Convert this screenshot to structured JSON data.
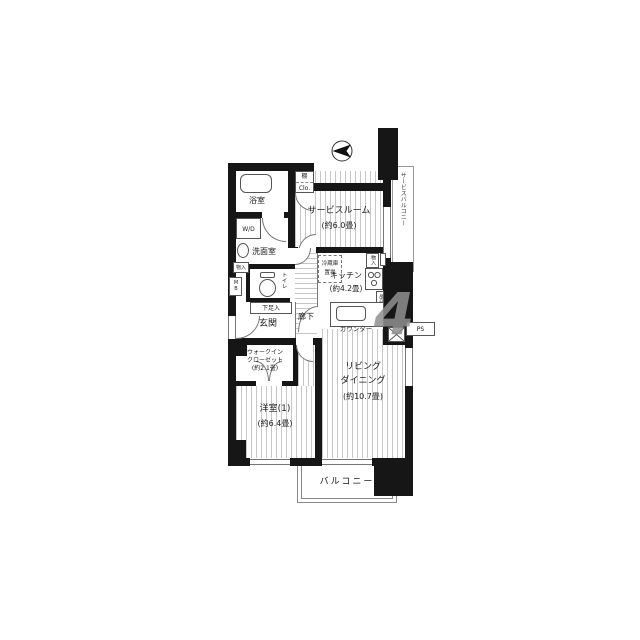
{
  "plan": {
    "watermark": "4",
    "rooms": {
      "service_room": {
        "name": "サービスルーム",
        "size": "(約6.0畳)"
      },
      "service_balcony": {
        "name": "サービスバルコニー"
      },
      "kitchen": {
        "name": "キッチン",
        "size": "(約4.2畳)"
      },
      "living_dining": {
        "line1": "リビング",
        "line2": "ダイニング",
        "size": "(約10.7畳)"
      },
      "western_room": {
        "name": "洋室(1)",
        "size": "(約6.4畳)"
      },
      "walk_in_closet": {
        "line1": "ウォークイン",
        "line2": "クローゼット",
        "size": "(約2.1畳)"
      },
      "bathroom": {
        "name": "浴室"
      },
      "washroom": {
        "name": "洗面室"
      },
      "toilet": {
        "name": "トイレ"
      },
      "entrance": {
        "name": "玄関"
      },
      "hallway": {
        "name": "廊下"
      },
      "balcony": {
        "name": "バルコニー"
      }
    },
    "fixtures": {
      "shelf": "棚",
      "closet_abbr": "Clo.",
      "washer_dryer": "W/D",
      "storage": "物入",
      "meter_box": "MB",
      "shoe_cabinet": "下足入",
      "fridge_line1": "冷蔵庫",
      "fridge_line2": "置場",
      "kitchen_storage": "物入",
      "counter": "カウンター",
      "hanging_cupboard": "吊戸棚",
      "pipe_space": "PS"
    }
  }
}
